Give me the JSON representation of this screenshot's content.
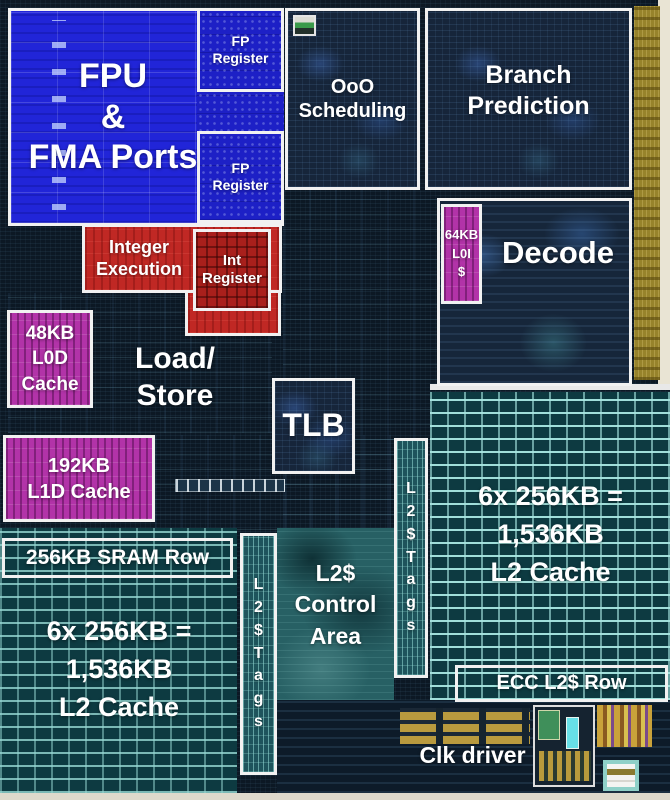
{
  "title": "Annotated CPU core die shot",
  "canvas": {
    "width": 670,
    "height": 800
  },
  "colors": {
    "fpu_blue": "#2125d8",
    "execution_red": "#c02824",
    "cache_magenta": "#b233a8",
    "sram_teal_line": "#a8e8e2",
    "die_dark": "#0c1824",
    "io_gold": "#97832b",
    "edge_cream": "#e9e4d4",
    "annotation_border": "#f1f1f1",
    "label_text": "#ffffff"
  },
  "labels": {
    "fpu": "FPU\n&\nFMA Ports",
    "fp_register_top": "FP\nRegister",
    "fp_register_bottom": "FP\nRegister",
    "ooo_scheduling": "OoO\nScheduling",
    "branch_prediction": "Branch\nPrediction",
    "integer_execution": "Integer\nExecution",
    "int_register": "Int\nRegister",
    "l0i_cache": "64KB\nL0I\n$",
    "decode": "Decode",
    "l0d_cache": "48KB\nL0D\nCache",
    "load_store": "Load/\nStore",
    "tlb": "TLB",
    "l1d_cache": "192KB\nL1D Cache",
    "sram_row": "256KB SRAM Row",
    "l2_cache_left": "6x 256KB =\n1,536KB\nL2 Cache",
    "l2_tags_left": "L\n2\n$\nT\na\ng\ns",
    "l2_control": "L2$\nControl\nArea",
    "l2_tags_right": "L\n2\n$\nT\na\ng\ns",
    "l2_cache_right": "6x 256KB =\n1,536KB\nL2 Cache",
    "ecc_row": "ECC L2$ Row",
    "clk_driver": "Clk driver"
  }
}
